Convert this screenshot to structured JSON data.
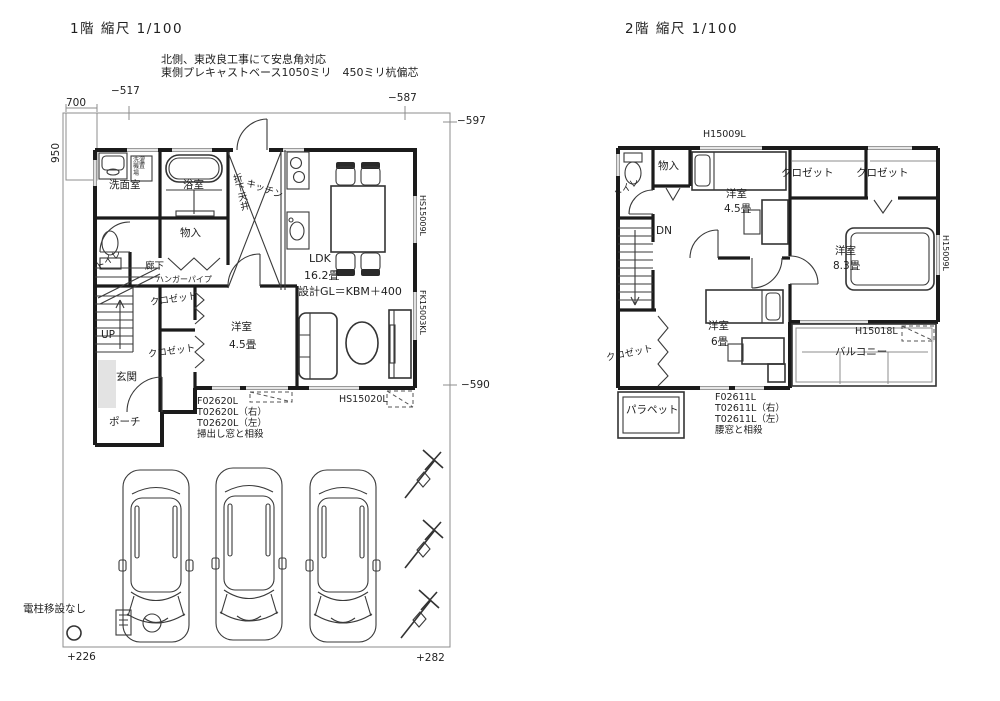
{
  "floor1": {
    "title": "1階 縮尺 1/100",
    "note1": "北側、東改良工事にて安息角対応",
    "note2": "東側プレキャストベース1050ミリ　450ミリ杭偏芯",
    "dims": {
      "top_left_width": "700",
      "left_height": "950",
      "offset_517": "−517",
      "offset_587": "−587",
      "offset_597": "−597",
      "offset_590": "−590",
      "offset_226": "+226",
      "offset_282": "+282"
    },
    "rooms": {
      "washroom": "洗面室",
      "washer_space": "洗濯機置場",
      "bathroom": "浴室",
      "dropped_ceiling": "折下天井",
      "kitchen": "キッチン",
      "storage": "物入",
      "hallway": "廊下",
      "hanger_pipe": "ハンガーパイプ",
      "toilet": "トイレ",
      "closet_upper": "クロゼット",
      "closet_lower": "クロゼット",
      "stairs_up": "UP",
      "entrance": "玄関",
      "porch": "ポーチ",
      "western_room": "洋室",
      "western_room_size": "4.5畳",
      "ldk": "LDK",
      "ldk_size": "16.2畳",
      "design_gl": "設計GL＝KBM＋400"
    },
    "window_ids": {
      "hs15009": "HS15009L",
      "fk15003": "FK15003KL",
      "hs15020": "HS15020L"
    },
    "window_note": {
      "l1": "F02620L",
      "l2": "T02620L（右）",
      "l3": "T02620L（左）",
      "l4": "掃出し窓と相殺"
    },
    "pole_note": "電柱移設なし"
  },
  "floor2": {
    "title": "2階 縮尺 1/100",
    "rooms": {
      "toilet": "トイレ",
      "storage": "物入",
      "western_room_45": "洋室",
      "western_room_45_size": "4.5畳",
      "closet_a": "クロゼット",
      "closet_b": "クロゼット",
      "western_room_83": "洋室",
      "western_room_83_size": "8.3畳",
      "stairs_down": "DN",
      "closet_c": "クロゼット",
      "western_room_6": "洋室",
      "western_room_6_size": "6畳",
      "parapet": "パラペット",
      "balcony": "バルコニー"
    },
    "window_ids": {
      "h15009_top": "H15009L",
      "h15009_right": "H15009L",
      "h15018": "H15018L"
    },
    "window_note": {
      "l1": "F02611L",
      "l2": "T02611L（右）",
      "l3": "T02611L（左）",
      "l4": "腰窓と相殺"
    }
  }
}
